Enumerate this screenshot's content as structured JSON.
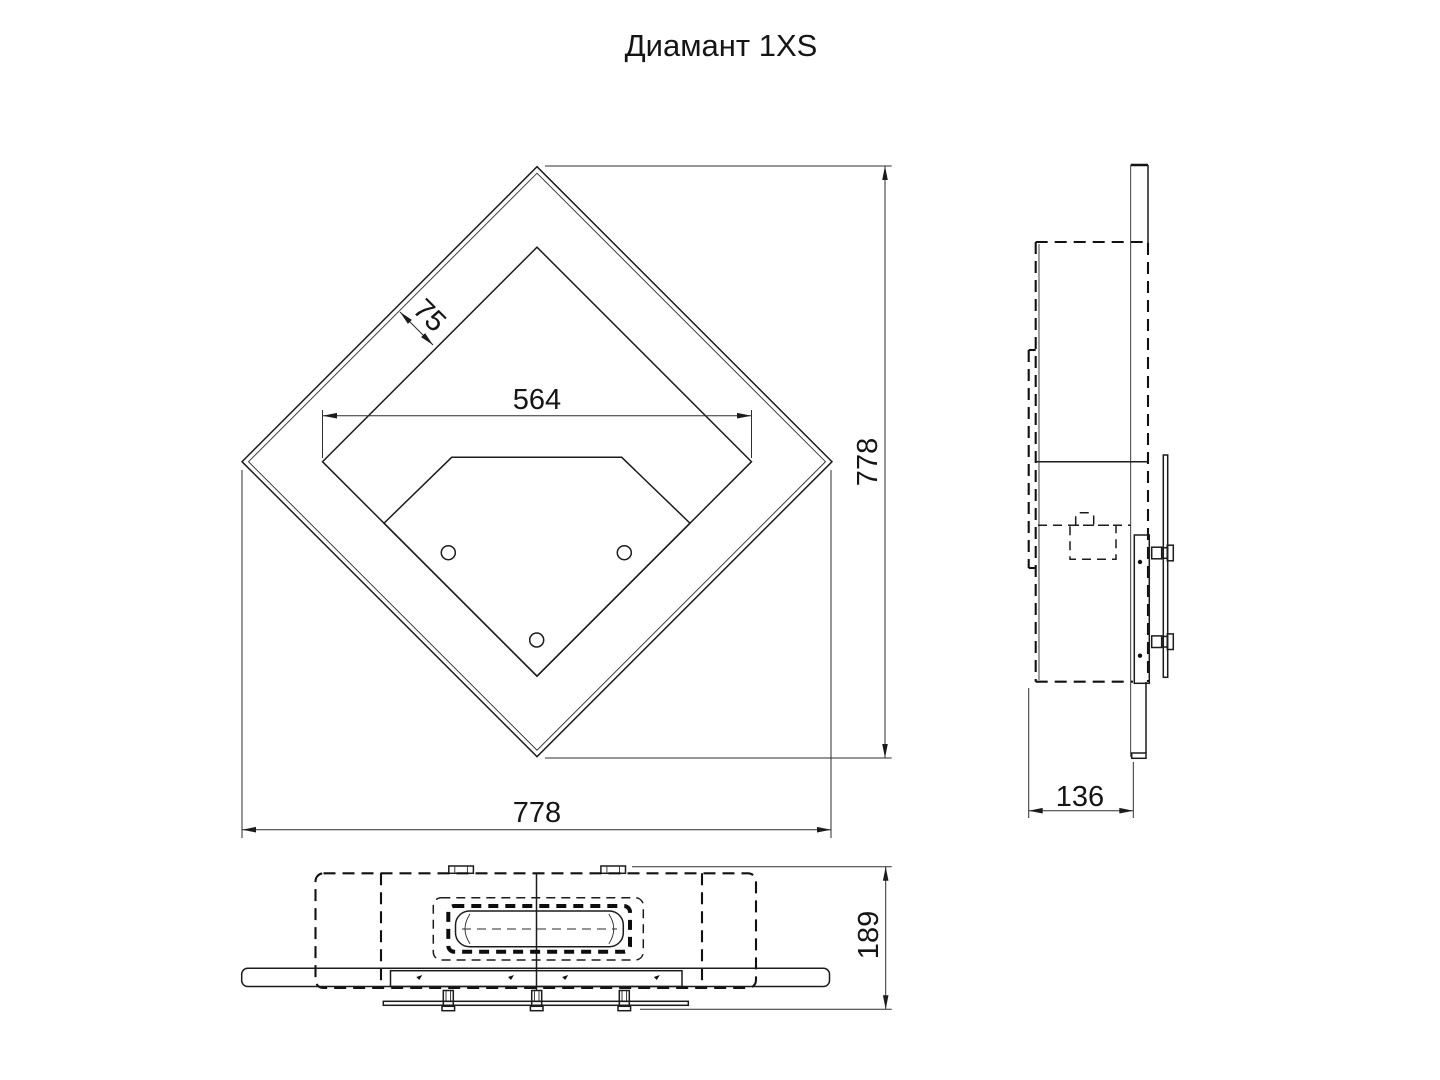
{
  "title": "Диамант 1XS",
  "drawing": {
    "front_view": {
      "dim_opening_width": "564",
      "dim_frame_offset": "75",
      "dim_height": "778",
      "dim_width": "778"
    },
    "side_view": {
      "dim_depth": "136"
    },
    "bottom_view": {
      "dim_total_depth": "189"
    }
  },
  "colors": {
    "line": "#1c1c1c",
    "dimension": "#2e2e2e",
    "background": "#ffffff"
  }
}
